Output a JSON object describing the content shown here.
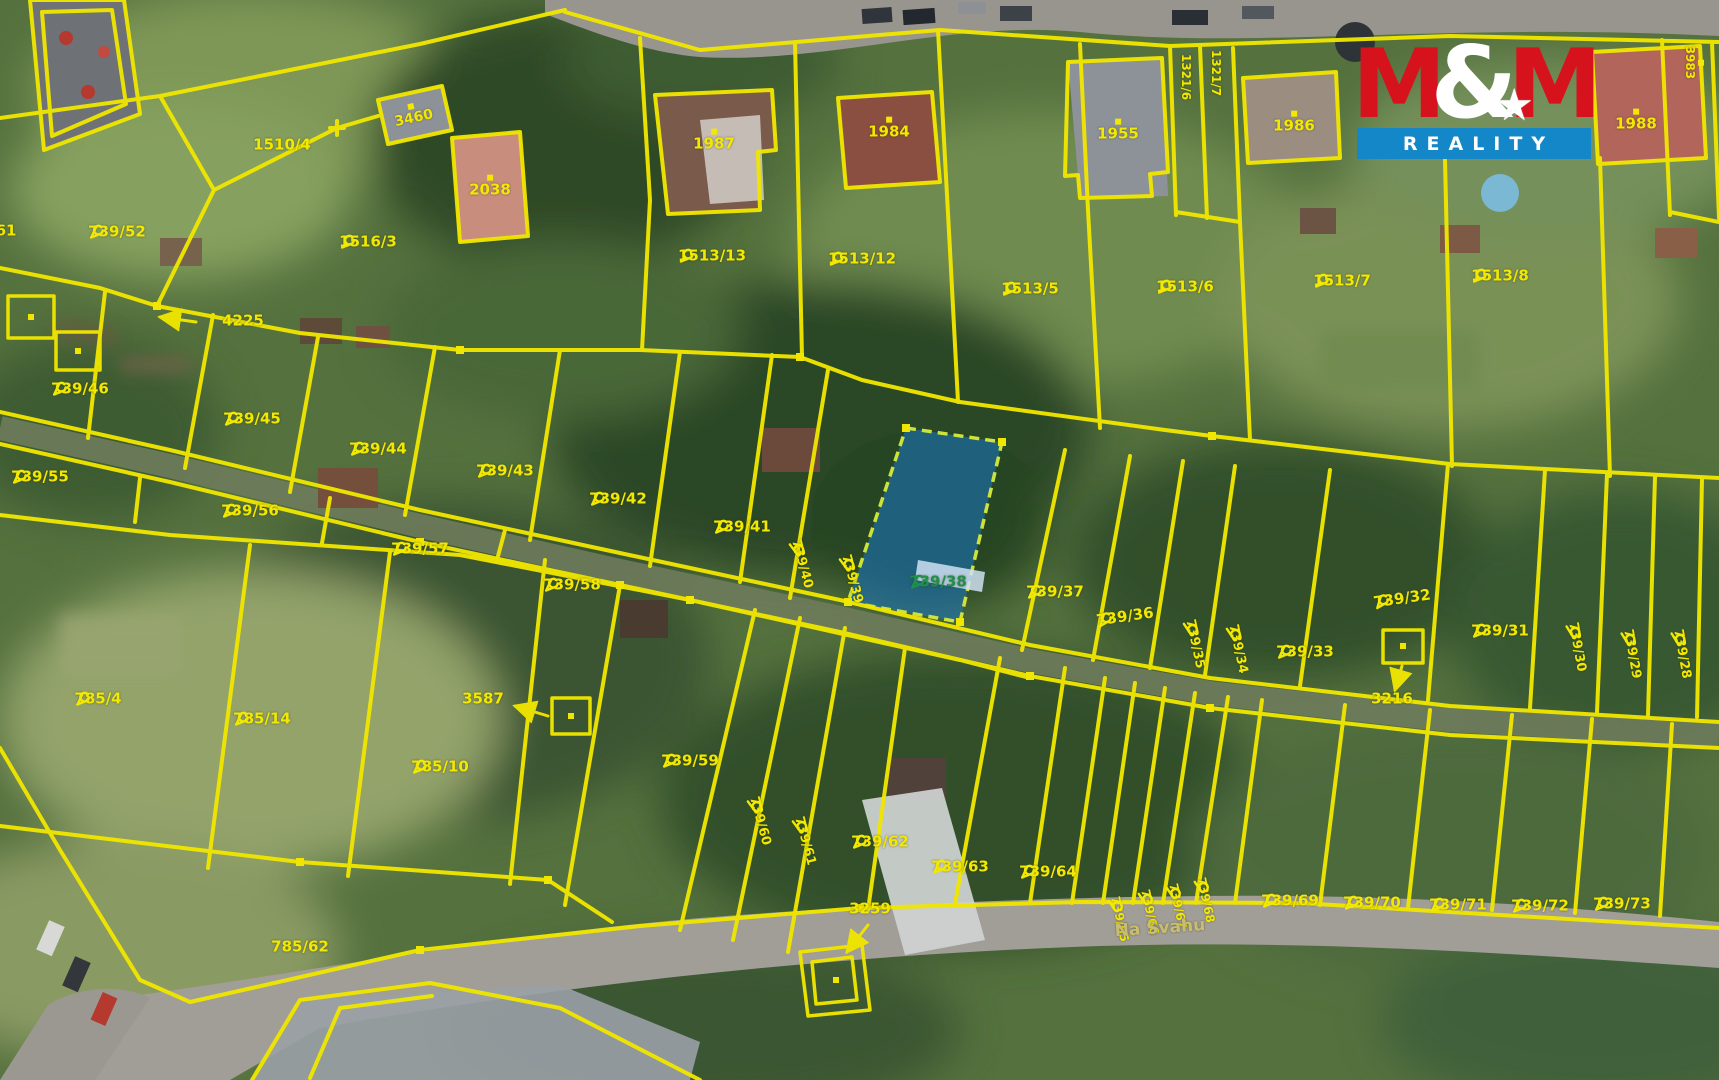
{
  "map": {
    "highlighted_parcel": "739/38",
    "highlight_fill": "#1976c6",
    "line_color": "#f0e600",
    "label_color": "#f2e800",
    "green_label_color": "#1f8f4a",
    "street_label_color": "#c9bd72",
    "labels": [
      {
        "text": "61",
        "x": 6,
        "y": 232
      },
      {
        "text": "739/52",
        "x": 117,
        "y": 233,
        "marker": "flag"
      },
      {
        "text": "1510/4",
        "x": 282,
        "y": 146
      },
      {
        "text": "3460",
        "x": 413,
        "y": 116,
        "rot": -12,
        "marker": "dot",
        "size": 14
      },
      {
        "text": "2038",
        "x": 490,
        "y": 188,
        "marker": "dot"
      },
      {
        "text": "1516/3",
        "x": 368,
        "y": 243,
        "marker": "flag"
      },
      {
        "text": "4225",
        "x": 243,
        "y": 322
      },
      {
        "text": "1987",
        "x": 714,
        "y": 142,
        "marker": "dot"
      },
      {
        "text": "1984",
        "x": 889,
        "y": 130,
        "marker": "dot"
      },
      {
        "text": "1955",
        "x": 1118,
        "y": 132,
        "marker": "dot"
      },
      {
        "text": "1986",
        "x": 1294,
        "y": 124,
        "marker": "dot"
      },
      {
        "text": "1988",
        "x": 1636,
        "y": 122,
        "marker": "dot"
      },
      {
        "text": "1321/6",
        "x": 1186,
        "y": 78,
        "rot": 90,
        "size": 12
      },
      {
        "text": "1321/7",
        "x": 1216,
        "y": 74,
        "rot": 90,
        "size": 12
      },
      {
        "text": "3983",
        "x": 1694,
        "y": 64,
        "rot": 90,
        "size": 12,
        "marker": "dot"
      },
      {
        "text": "1513/13",
        "x": 712,
        "y": 257,
        "marker": "flag"
      },
      {
        "text": "1513/12",
        "x": 862,
        "y": 260,
        "marker": "flag"
      },
      {
        "text": "1513/5",
        "x": 1030,
        "y": 290,
        "marker": "flag"
      },
      {
        "text": "1513/6",
        "x": 1185,
        "y": 288,
        "marker": "flag"
      },
      {
        "text": "1513/7",
        "x": 1342,
        "y": 282,
        "marker": "flag"
      },
      {
        "text": "1513/8",
        "x": 1500,
        "y": 277,
        "marker": "flag"
      },
      {
        "text": "739/46",
        "x": 80,
        "y": 390,
        "marker": "flag"
      },
      {
        "text": "739/45",
        "x": 252,
        "y": 420,
        "marker": "flag"
      },
      {
        "text": "739/44",
        "x": 378,
        "y": 450,
        "marker": "flag"
      },
      {
        "text": "739/43",
        "x": 505,
        "y": 472,
        "marker": "flag"
      },
      {
        "text": "739/42",
        "x": 618,
        "y": 500,
        "marker": "flag"
      },
      {
        "text": "739/41",
        "x": 742,
        "y": 528,
        "marker": "flag"
      },
      {
        "text": "739/40",
        "x": 802,
        "y": 565,
        "rot": 75,
        "marker": "flag",
        "size": 13
      },
      {
        "text": "739/39",
        "x": 852,
        "y": 580,
        "rot": 75,
        "marker": "flag",
        "size": 13
      },
      {
        "text": "739/38",
        "x": 938,
        "y": 583,
        "color": "#1f8f4a",
        "marker": "flag"
      },
      {
        "text": "739/37",
        "x": 1055,
        "y": 593,
        "marker": "flag"
      },
      {
        "text": "739/36",
        "x": 1125,
        "y": 618,
        "rot": -8,
        "marker": "flag"
      },
      {
        "text": "739/35",
        "x": 1195,
        "y": 645,
        "rot": 78,
        "marker": "flag",
        "size": 13
      },
      {
        "text": "739/34",
        "x": 1238,
        "y": 650,
        "rot": 78,
        "marker": "flag",
        "size": 13
      },
      {
        "text": "739/33",
        "x": 1305,
        "y": 653,
        "marker": "flag"
      },
      {
        "text": "739/32",
        "x": 1402,
        "y": 600,
        "rot": -8,
        "marker": "flag"
      },
      {
        "text": "739/31",
        "x": 1500,
        "y": 632,
        "marker": "flag"
      },
      {
        "text": "739/30",
        "x": 1577,
        "y": 648,
        "rot": 80,
        "marker": "flag",
        "size": 13
      },
      {
        "text": "739/29",
        "x": 1632,
        "y": 655,
        "rot": 80,
        "marker": "flag",
        "size": 13
      },
      {
        "text": "739/28",
        "x": 1682,
        "y": 655,
        "rot": 80,
        "marker": "flag",
        "size": 13
      },
      {
        "text": "3216",
        "x": 1392,
        "y": 700
      },
      {
        "text": "739/55",
        "x": 40,
        "y": 478,
        "marker": "flag"
      },
      {
        "text": "739/56",
        "x": 250,
        "y": 512,
        "marker": "flag"
      },
      {
        "text": "739/57",
        "x": 420,
        "y": 550,
        "marker": "flag"
      },
      {
        "text": "739/58",
        "x": 572,
        "y": 586,
        "marker": "flag"
      },
      {
        "text": "785/4",
        "x": 98,
        "y": 700,
        "marker": "flag"
      },
      {
        "text": "785/14",
        "x": 262,
        "y": 720,
        "marker": "flag"
      },
      {
        "text": "785/10",
        "x": 440,
        "y": 768,
        "marker": "flag"
      },
      {
        "text": "3587",
        "x": 483,
        "y": 700
      },
      {
        "text": "739/59",
        "x": 690,
        "y": 762,
        "marker": "flag"
      },
      {
        "text": "739/60",
        "x": 760,
        "y": 822,
        "rot": 75,
        "marker": "flag",
        "size": 13
      },
      {
        "text": "739/61",
        "x": 805,
        "y": 842,
        "rot": 75,
        "marker": "flag",
        "size": 13
      },
      {
        "text": "739/62",
        "x": 880,
        "y": 843,
        "marker": "flag"
      },
      {
        "text": "739/63",
        "x": 960,
        "y": 868,
        "marker": "flag"
      },
      {
        "text": "739/64",
        "x": 1048,
        "y": 873,
        "marker": "flag"
      },
      {
        "text": "3259",
        "x": 870,
        "y": 910
      },
      {
        "text": "739/65",
        "x": 1120,
        "y": 920,
        "rot": 78,
        "marker": "flag",
        "size": 12
      },
      {
        "text": "739/66",
        "x": 1150,
        "y": 913,
        "rot": 78,
        "marker": "flag",
        "size": 12
      },
      {
        "text": "739/67",
        "x": 1178,
        "y": 907,
        "rot": 78,
        "marker": "flag",
        "size": 12
      },
      {
        "text": "739/68",
        "x": 1206,
        "y": 901,
        "rot": 78,
        "marker": "flag",
        "size": 12
      },
      {
        "text": "739/69",
        "x": 1290,
        "y": 902,
        "marker": "flag"
      },
      {
        "text": "739/70",
        "x": 1372,
        "y": 904,
        "marker": "flag"
      },
      {
        "text": "739/71",
        "x": 1458,
        "y": 906,
        "marker": "flag"
      },
      {
        "text": "739/72",
        "x": 1540,
        "y": 907,
        "marker": "flag"
      },
      {
        "text": "739/73",
        "x": 1622,
        "y": 905,
        "marker": "flag"
      },
      {
        "text": "785/62",
        "x": 300,
        "y": 948
      },
      {
        "text": "Na Svahu",
        "x": 1160,
        "y": 930,
        "rot": -4,
        "color": "#c9bd72",
        "size": 17,
        "name": "street-name-label"
      }
    ]
  },
  "logo": {
    "m1": "M",
    "amp": "&",
    "m2": "M",
    "reality": "REALITY"
  }
}
